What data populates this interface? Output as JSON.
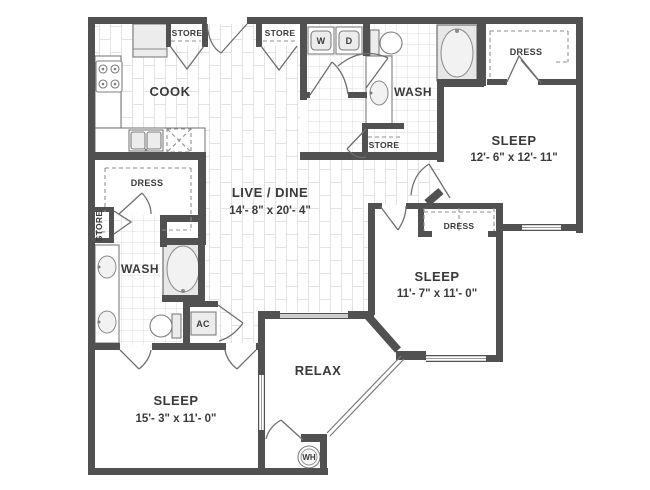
{
  "colors": {
    "wall": "#515151",
    "label": "#3a3a3a",
    "tile_line": "#dcdcdc",
    "plank_line": "#e3e3e3",
    "fixture_stroke": "#7d7d7d"
  },
  "rooms": {
    "cook": {
      "label": "COOK"
    },
    "live_dine": {
      "label": "LIVE / DINE",
      "dims": "14'- 8\" x 20'- 4\""
    },
    "wash_top": {
      "label": "WASH"
    },
    "wash_bottom": {
      "label": "WASH"
    },
    "sleep_top_right": {
      "label": "SLEEP",
      "dims": "12'- 6\" x 12'- 11\""
    },
    "sleep_bottom_right": {
      "label": "SLEEP",
      "dims": "11'- 7\" x 11'- 0\""
    },
    "sleep_bottom_left": {
      "label": "SLEEP",
      "dims": "15'- 3\" x 11'- 0\""
    },
    "relax": {
      "label": "RELAX"
    }
  },
  "closets": {
    "dress_top_right": {
      "label": "DRESS"
    },
    "dress_left": {
      "label": "DRESS"
    },
    "dress_bottom_right": {
      "label": "DRESS"
    },
    "store_kitchen": {
      "label": "STORE"
    },
    "store_entry": {
      "label": "STORE"
    },
    "store_bath": {
      "label": "STORE"
    },
    "store_left": {
      "label": "STORE"
    },
    "ac": {
      "label": "AC"
    },
    "wh": {
      "label": "WH"
    }
  },
  "appliances": {
    "washer": {
      "label": "W"
    },
    "dryer": {
      "label": "D"
    }
  }
}
